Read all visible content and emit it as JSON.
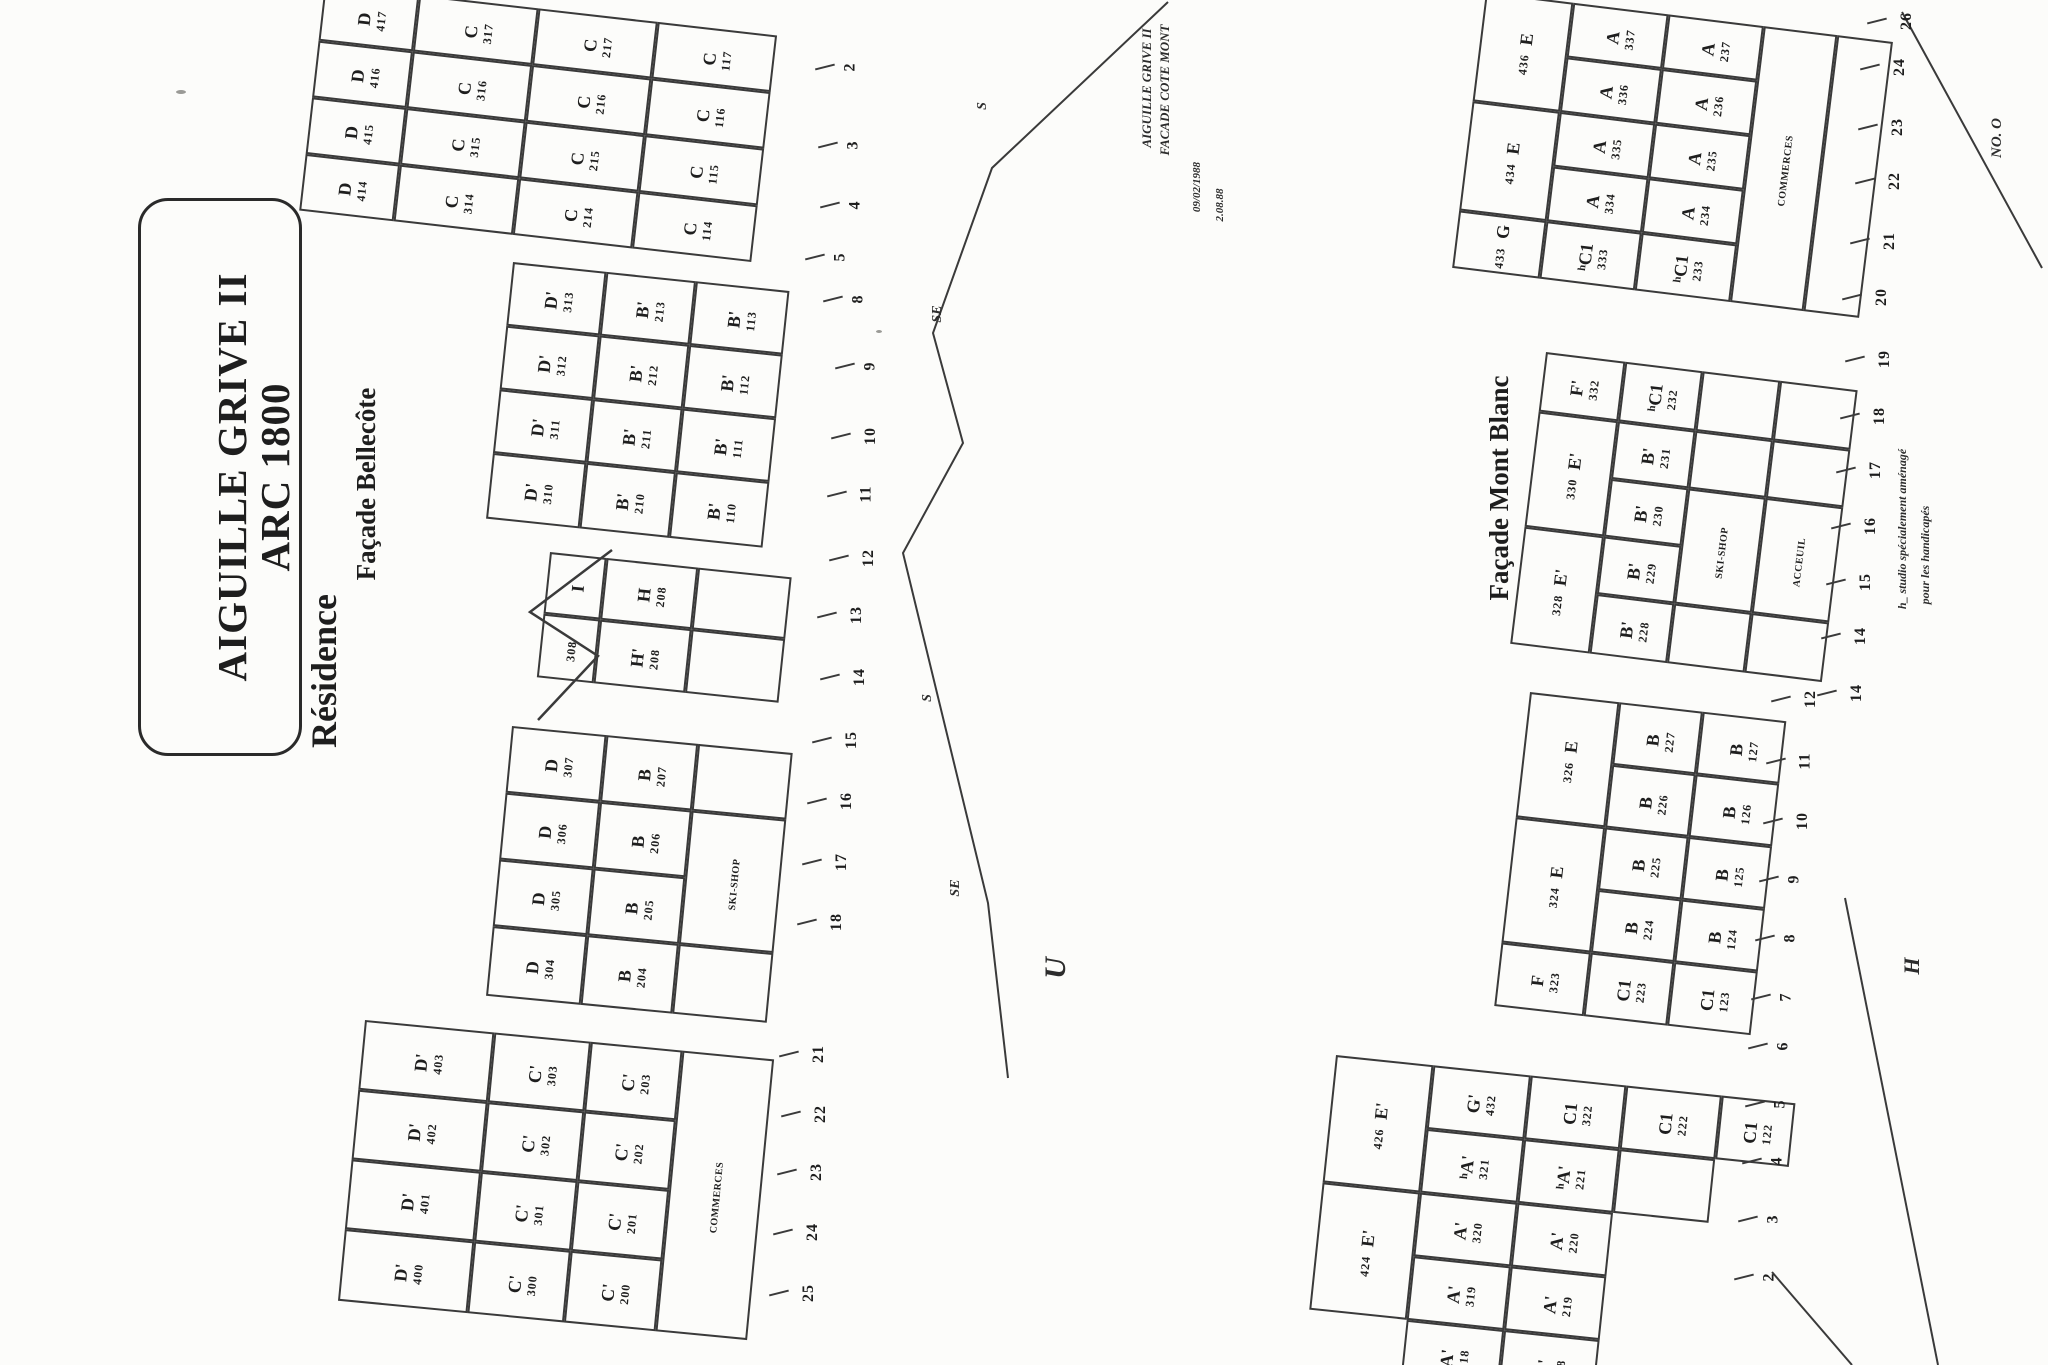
{
  "title": {
    "line1": "Résidence",
    "line2": "AIGUILLE GRIVE II",
    "line3": "ARC 1800"
  },
  "labels": {
    "bellecote": "Façade Bellecôte",
    "montblanc": "Façade Mont Blanc"
  },
  "annotations": {
    "note1_line1": "AIGUILLE GRIVE II",
    "note1_line2": "FACADE COTE MONT",
    "note1_date1": "09/02/1988",
    "note1_date2": "2.08.88",
    "note2_line1": "h_ studio spécialement aménagé",
    "note2_line2": "pour les handicapés",
    "letters": [
      {
        "text": "U",
        "cx": 1056,
        "cy": 968,
        "size": 30
      },
      {
        "text": "H",
        "cx": 1912,
        "cy": 966,
        "size": 22
      },
      {
        "text": "NO. O",
        "cx": 1997,
        "cy": 138,
        "size": 15
      }
    ],
    "profile_labels": [
      {
        "text": "S",
        "cx": 983,
        "cy": 106
      },
      {
        "text": "SE",
        "cx": 938,
        "cy": 314
      },
      {
        "text": "S",
        "cx": 928,
        "cy": 698
      },
      {
        "text": "SE",
        "cx": 956,
        "cy": 888
      }
    ]
  },
  "ink": "#1e1e1e",
  "line_color": "#3a3a3a",
  "blocks": [
    {
      "id": "facade-cote-mont-upper",
      "x": 325,
      "y": -16,
      "rot": 6.5,
      "cols": [
        95,
        120,
        120,
        120
      ],
      "rows": [
        57,
        57,
        57,
        57
      ],
      "cells": [
        [
          0,
          0,
          1,
          "D",
          "417",
          "n"
        ],
        [
          0,
          1,
          1,
          "D",
          "416",
          "n"
        ],
        [
          0,
          2,
          1,
          "D",
          "415",
          "n"
        ],
        [
          0,
          3,
          1,
          "D",
          "414",
          "n"
        ],
        [
          1,
          0,
          1,
          "C",
          "317",
          "n"
        ],
        [
          1,
          1,
          1,
          "C",
          "316",
          "n"
        ],
        [
          1,
          2,
          1,
          "C",
          "315",
          "n"
        ],
        [
          1,
          3,
          1,
          "C",
          "314",
          "n"
        ],
        [
          2,
          0,
          1,
          "C",
          "217",
          "n"
        ],
        [
          2,
          1,
          1,
          "C",
          "216",
          "n"
        ],
        [
          2,
          2,
          1,
          "C",
          "215",
          "n"
        ],
        [
          2,
          3,
          1,
          "C",
          "214",
          "n"
        ],
        [
          3,
          0,
          1,
          "C",
          "117",
          "n"
        ],
        [
          3,
          1,
          1,
          "C",
          "116",
          "n"
        ],
        [
          3,
          2,
          1,
          "C",
          "115",
          "n"
        ],
        [
          3,
          3,
          1,
          "C",
          "114",
          "n"
        ]
      ]
    },
    {
      "id": "bellecote-right",
      "x": 513,
      "y": 262,
      "rot": 6,
      "cols": [
        94,
        90,
        94
      ],
      "rows": [
        64,
        64,
        64,
        66
      ],
      "cells": [
        [
          0,
          0,
          1,
          "D'",
          "313",
          "n"
        ],
        [
          0,
          1,
          1,
          "D'",
          "312",
          "n"
        ],
        [
          0,
          2,
          1,
          "D'",
          "311",
          "n"
        ],
        [
          0,
          3,
          1,
          "D'",
          "310",
          "n"
        ],
        [
          1,
          0,
          1,
          "B'",
          "213",
          "n"
        ],
        [
          1,
          1,
          1,
          "B'",
          "212",
          "n"
        ],
        [
          1,
          2,
          1,
          "B'",
          "211",
          "n"
        ],
        [
          1,
          3,
          1,
          "B'",
          "210",
          "n"
        ],
        [
          2,
          0,
          1,
          "B'",
          "113",
          "n"
        ],
        [
          2,
          1,
          1,
          "B'",
          "112",
          "n"
        ],
        [
          2,
          2,
          1,
          "B'",
          "111",
          "n"
        ],
        [
          2,
          3,
          1,
          "B'",
          "110",
          "n"
        ]
      ]
    },
    {
      "id": "bellecote-tower",
      "x": 550,
      "y": 552,
      "rot": 6,
      "cols": [
        57,
        92,
        94
      ],
      "rows": [
        62,
        64
      ],
      "cells": [
        [
          0,
          0,
          1,
          "I",
          "",
          "n"
        ],
        [
          0,
          1,
          1,
          "",
          "308",
          "n"
        ],
        [
          1,
          0,
          1,
          "H",
          "208",
          "n"
        ],
        [
          1,
          1,
          1,
          "H'",
          "208",
          "n"
        ],
        [
          2,
          0,
          1,
          "",
          "",
          "n"
        ],
        [
          2,
          1,
          1,
          "",
          "",
          "n"
        ]
      ]
    },
    {
      "id": "bellecote-left",
      "x": 512,
      "y": 726,
      "rot": 5.5,
      "cols": [
        95,
        92,
        95
      ],
      "rows": [
        67,
        67,
        67,
        70
      ],
      "cells": [
        [
          0,
          0,
          1,
          "D",
          "307",
          "n"
        ],
        [
          0,
          1,
          1,
          "D",
          "306",
          "n"
        ],
        [
          0,
          2,
          1,
          "D",
          "305",
          "n"
        ],
        [
          0,
          3,
          1,
          "D",
          "304",
          "n"
        ],
        [
          1,
          0,
          1,
          "B",
          "207",
          "n"
        ],
        [
          1,
          1,
          1,
          "B",
          "206",
          "n"
        ],
        [
          1,
          2,
          1,
          "B",
          "205",
          "n"
        ],
        [
          1,
          3,
          1,
          "B",
          "204",
          "n"
        ],
        [
          2,
          0,
          1,
          "",
          "",
          "n"
        ],
        [
          2,
          1,
          2,
          "SKI-SHOP",
          "",
          "t"
        ],
        [
          2,
          3,
          1,
          "",
          "",
          "n"
        ]
      ]
    },
    {
      "id": "bellecote-lower",
      "x": 365,
      "y": 1020,
      "rot": 5.5,
      "cols": [
        130,
        97,
        92,
        92
      ],
      "rows": [
        70,
        70,
        70,
        72
      ],
      "cells": [
        [
          0,
          0,
          1,
          "D'",
          "403",
          "n"
        ],
        [
          0,
          1,
          1,
          "D'",
          "402",
          "n"
        ],
        [
          0,
          2,
          1,
          "D'",
          "401",
          "n"
        ],
        [
          0,
          3,
          1,
          "D'",
          "400",
          "n"
        ],
        [
          1,
          0,
          1,
          "C'",
          "303",
          "n"
        ],
        [
          1,
          1,
          1,
          "C'",
          "302",
          "n"
        ],
        [
          1,
          2,
          1,
          "C'",
          "301",
          "n"
        ],
        [
          1,
          3,
          1,
          "C'",
          "300",
          "n"
        ],
        [
          2,
          0,
          1,
          "C'",
          "203",
          "n"
        ],
        [
          2,
          1,
          1,
          "C'",
          "202",
          "n"
        ],
        [
          2,
          2,
          1,
          "C'",
          "201",
          "n"
        ],
        [
          2,
          3,
          1,
          "C'",
          "200",
          "n"
        ],
        [
          3,
          0,
          4,
          "COMMERCES",
          "",
          "t"
        ]
      ]
    },
    {
      "id": "montblanc-upper",
      "x": 1486,
      "y": -8,
      "rot": 7,
      "cols": [
        88,
        96,
        96,
        74,
        56
      ],
      "rows": [
        55,
        55,
        55,
        55,
        58
      ],
      "cells": [
        [
          0,
          0,
          2,
          "E",
          "436",
          "s"
        ],
        [
          0,
          2,
          2,
          "E",
          "434",
          "s"
        ],
        [
          0,
          4,
          1,
          "G",
          "433",
          "s"
        ],
        [
          1,
          0,
          1,
          "A",
          "337",
          "n"
        ],
        [
          1,
          1,
          1,
          "A",
          "336",
          "n"
        ],
        [
          1,
          2,
          1,
          "A",
          "335",
          "n"
        ],
        [
          1,
          3,
          1,
          "A",
          "334",
          "n"
        ],
        [
          1,
          4,
          1,
          "ʰC1",
          "333",
          "n"
        ],
        [
          2,
          0,
          1,
          "A",
          "237",
          "n"
        ],
        [
          2,
          1,
          1,
          "A",
          "236",
          "n"
        ],
        [
          2,
          2,
          1,
          "A",
          "235",
          "n"
        ],
        [
          2,
          3,
          1,
          "A",
          "234",
          "n"
        ],
        [
          2,
          4,
          1,
          "ʰC1",
          "233",
          "n"
        ],
        [
          3,
          0,
          5,
          "COMMERCES",
          "",
          "t"
        ],
        [
          4,
          0,
          5,
          "",
          "",
          "n"
        ]
      ]
    },
    {
      "id": "montblanc-mid",
      "x": 1546,
      "y": 352,
      "rot": 7,
      "cols": [
        80,
        78,
        78,
        78
      ],
      "rows": [
        60,
        58,
        58,
        58,
        60
      ],
      "cells": [
        [
          0,
          0,
          1,
          "F'",
          "332",
          "n"
        ],
        [
          0,
          1,
          2,
          "E'",
          "330",
          "s"
        ],
        [
          0,
          3,
          2,
          "E'",
          "328",
          "s"
        ],
        [
          1,
          0,
          1,
          "ʰC1",
          "232",
          "n"
        ],
        [
          1,
          1,
          1,
          "B'",
          "231",
          "n"
        ],
        [
          1,
          2,
          1,
          "B'",
          "230",
          "n"
        ],
        [
          1,
          3,
          1,
          "B'",
          "229",
          "n"
        ],
        [
          1,
          4,
          1,
          "B'",
          "228",
          "n"
        ],
        [
          2,
          0,
          1,
          "",
          "",
          "n"
        ],
        [
          2,
          1,
          1,
          "",
          "",
          "n"
        ],
        [
          2,
          2,
          2,
          "SKI-SHOP",
          "",
          "t"
        ],
        [
          2,
          4,
          1,
          "",
          "",
          "n"
        ],
        [
          3,
          0,
          1,
          "",
          "",
          "n"
        ],
        [
          3,
          1,
          1,
          "",
          "",
          "n"
        ],
        [
          3,
          2,
          2,
          "ACCEUIL",
          "",
          "t"
        ],
        [
          3,
          4,
          1,
          "",
          "",
          "n"
        ]
      ]
    },
    {
      "id": "montblanc-lower",
      "x": 1530,
      "y": 692,
      "rot": 6.5,
      "cols": [
        90,
        84,
        84
      ],
      "rows": [
        63,
        63,
        63,
        63,
        64
      ],
      "cells": [
        [
          0,
          0,
          2,
          "E",
          "326",
          "s"
        ],
        [
          0,
          2,
          2,
          "E",
          "324",
          "s"
        ],
        [
          0,
          4,
          1,
          "F",
          "323",
          "n"
        ],
        [
          1,
          0,
          1,
          "B",
          "227",
          "n"
        ],
        [
          1,
          1,
          1,
          "B",
          "226",
          "n"
        ],
        [
          1,
          2,
          1,
          "B",
          "225",
          "n"
        ],
        [
          1,
          3,
          1,
          "B",
          "224",
          "n"
        ],
        [
          1,
          4,
          1,
          "C1",
          "223",
          "n"
        ],
        [
          2,
          0,
          1,
          "B",
          "127",
          "n"
        ],
        [
          2,
          1,
          1,
          "B",
          "126",
          "n"
        ],
        [
          2,
          2,
          1,
          "B",
          "125",
          "n"
        ],
        [
          2,
          3,
          1,
          "B",
          "124",
          "n"
        ],
        [
          2,
          4,
          1,
          "C1",
          "123",
          "n"
        ]
      ]
    },
    {
      "id": "montblanc-bottom",
      "x": 1336,
      "y": 1055,
      "rot": 6,
      "cols": [
        98,
        98,
        96,
        96,
        74
      ],
      "rows": [
        64,
        64,
        64,
        64,
        64
      ],
      "cells": [
        [
          0,
          0,
          2,
          "E'",
          "426",
          "s"
        ],
        [
          0,
          2,
          2,
          "E'",
          "424",
          "s"
        ],
        [
          1,
          0,
          1,
          "G'",
          "432",
          "n"
        ],
        [
          1,
          1,
          1,
          "ʰA'",
          "321",
          "n"
        ],
        [
          1,
          2,
          1,
          "A'",
          "320",
          "n"
        ],
        [
          1,
          3,
          1,
          "A'",
          "319",
          "n"
        ],
        [
          1,
          4,
          1,
          "A'",
          "318",
          "n"
        ],
        [
          2,
          0,
          1,
          "C1",
          "322",
          "n"
        ],
        [
          2,
          1,
          1,
          "ʰA'",
          "221",
          "n"
        ],
        [
          2,
          2,
          1,
          "A'",
          "220",
          "n"
        ],
        [
          2,
          3,
          1,
          "A'",
          "219",
          "n"
        ],
        [
          2,
          4,
          1,
          "A'",
          "218",
          "n"
        ],
        [
          3,
          0,
          1,
          "C1",
          "222",
          "n"
        ],
        [
          3,
          1,
          1,
          "",
          "",
          "n"
        ],
        [
          4,
          0,
          1,
          "C1",
          "122",
          "n"
        ]
      ]
    }
  ],
  "ticks": {
    "left": [
      [
        "2",
        846,
        58
      ],
      [
        "3",
        849,
        136
      ],
      [
        "4",
        851,
        196
      ],
      [
        "5",
        836,
        248
      ],
      [
        "8",
        854,
        290
      ],
      [
        "9",
        866,
        357
      ],
      [
        "10",
        862,
        427
      ],
      [
        "11",
        858,
        485
      ],
      [
        "12",
        860,
        549
      ],
      [
        "13",
        848,
        606
      ],
      [
        "14",
        851,
        668
      ],
      [
        "15",
        843,
        731
      ],
      [
        "16",
        838,
        792
      ],
      [
        "17",
        833,
        853
      ],
      [
        "18",
        828,
        913
      ],
      [
        "21",
        810,
        1045
      ],
      [
        "22",
        812,
        1105
      ],
      [
        "23",
        808,
        1163
      ],
      [
        "24",
        804,
        1223
      ],
      [
        "25",
        800,
        1284
      ]
    ],
    "right": [
      [
        "26",
        1898,
        12
      ],
      [
        "24",
        1891,
        58
      ],
      [
        "23",
        1889,
        118
      ],
      [
        "22",
        1886,
        172
      ],
      [
        "21",
        1881,
        232
      ],
      [
        "20",
        1873,
        288
      ],
      [
        "19",
        1876,
        350
      ],
      [
        "18",
        1871,
        407
      ],
      [
        "17",
        1867,
        461
      ],
      [
        "16",
        1862,
        517
      ],
      [
        "15",
        1857,
        573
      ],
      [
        "14",
        1852,
        627
      ],
      [
        "14",
        1848,
        684
      ],
      [
        "12",
        1802,
        690
      ],
      [
        "11",
        1797,
        752
      ],
      [
        "10",
        1794,
        812
      ],
      [
        "9",
        1790,
        870
      ],
      [
        "8",
        1786,
        929
      ],
      [
        "7",
        1782,
        988
      ],
      [
        "6",
        1779,
        1037
      ],
      [
        "5",
        1776,
        1095
      ],
      [
        "4",
        1773,
        1152
      ],
      [
        "3",
        1769,
        1210
      ],
      [
        "2",
        1765,
        1268
      ]
    ]
  },
  "profile_polyline": "1168,2 992,168 933,333 963,443 903,553 988,903 1008,1078",
  "extra_lines": [
    [
      1902,
      12,
      2042,
      268
    ],
    [
      1845,
      898,
      1938,
      1365
    ],
    [
      1772,
      1272,
      1852,
      1365
    ]
  ],
  "tower_roof": "612,550 530,612 598,656 538,720"
}
